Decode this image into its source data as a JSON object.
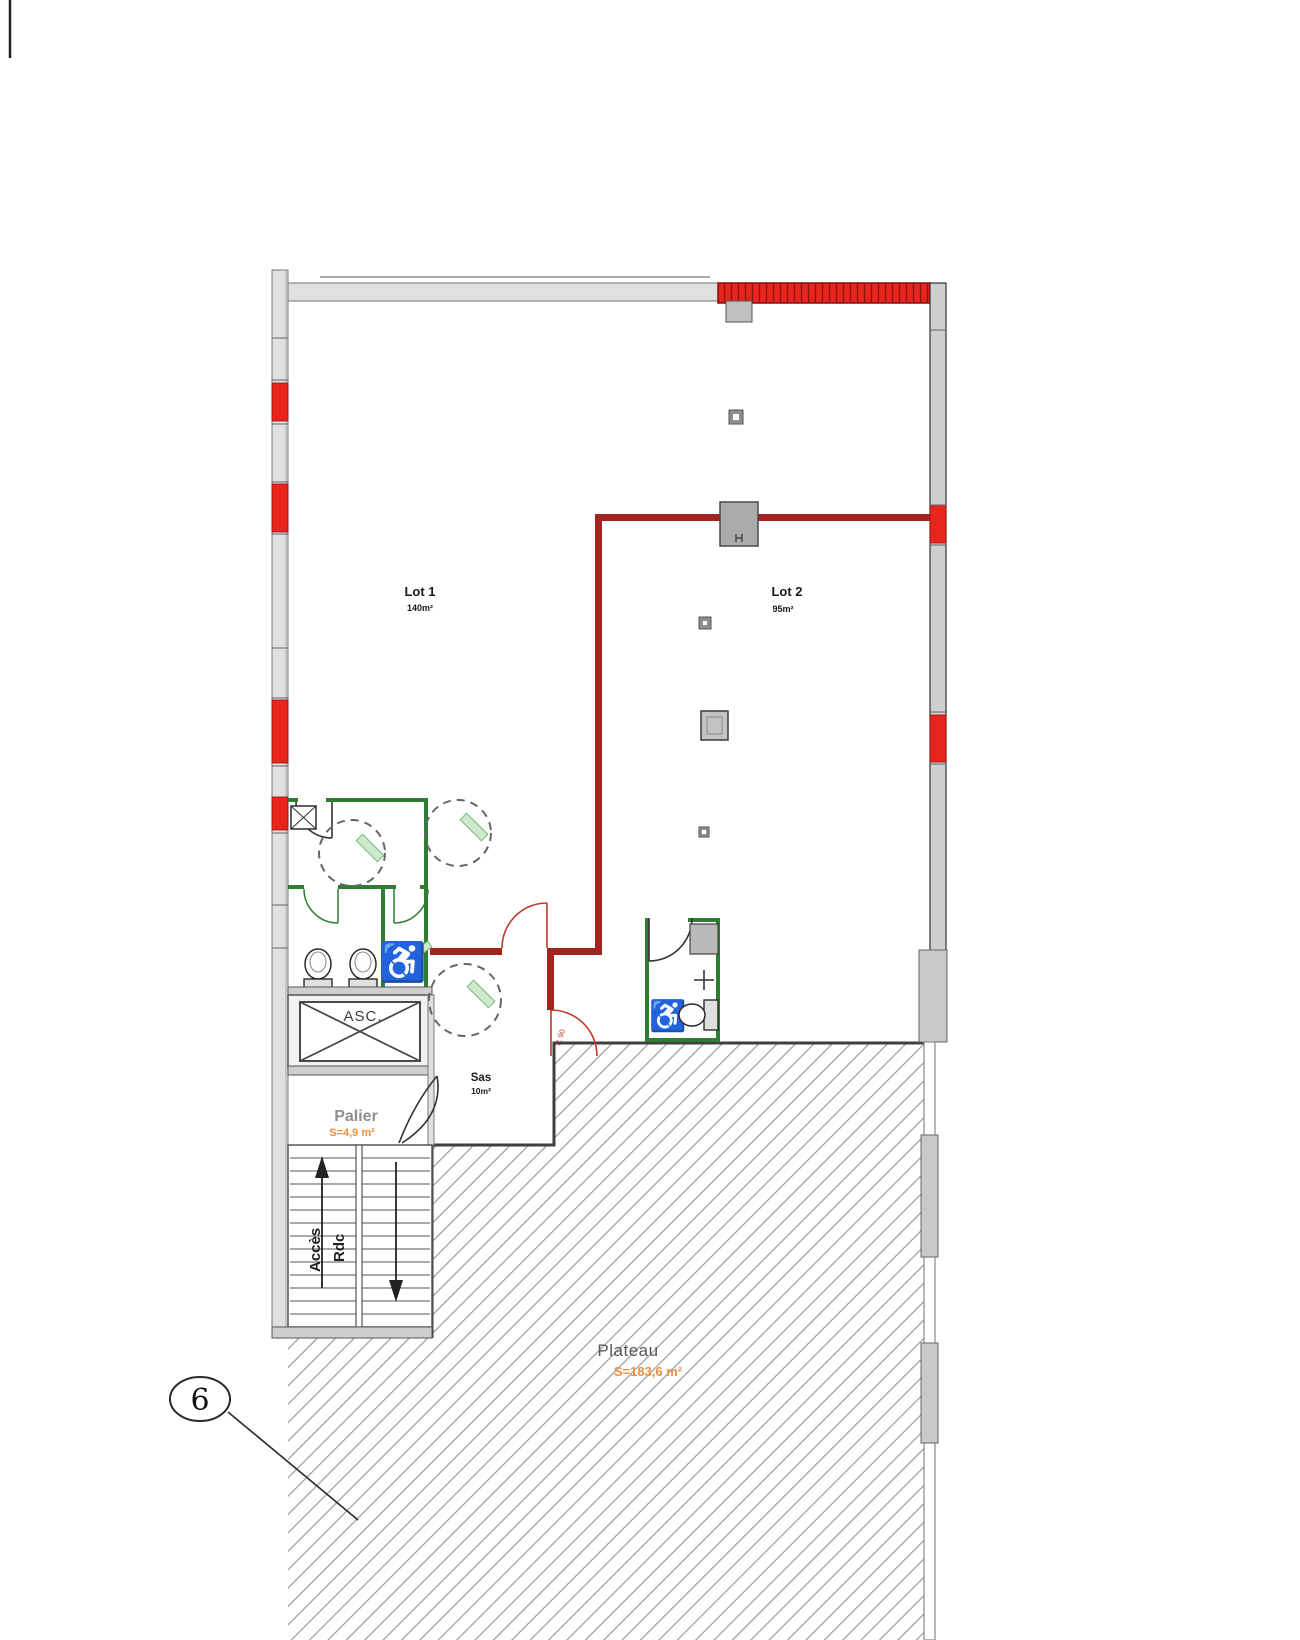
{
  "drawing": {
    "type": "floor-plan",
    "labels": {
      "lot1_name": "Lot 1",
      "lot1_area": "140m²",
      "lot2_name": "Lot 2",
      "lot2_area": "95m²",
      "elevator": "ASC.",
      "palier_name": "Palier",
      "palier_area": "S=4,9 m²",
      "sas_name": "Sas",
      "sas_area": "10m²",
      "plateau_name": "Plateau",
      "plateau_area": "S=183,6 m²",
      "stairs_line1": "Accès",
      "stairs_line2": "Rdc",
      "door_width": "P. 90",
      "callout_number": "6"
    },
    "icons": {
      "wheelchair": "♿"
    },
    "colors": {
      "new_wall_red": "#e8251d",
      "interior_wall_red": "#a0241f",
      "sanitary_wall_green": "#2e7d32",
      "area_text_orange": "#ef8f3f",
      "wall_gray": "#e0e0e0",
      "hatch_line_gray": "#9b9b9b"
    }
  }
}
